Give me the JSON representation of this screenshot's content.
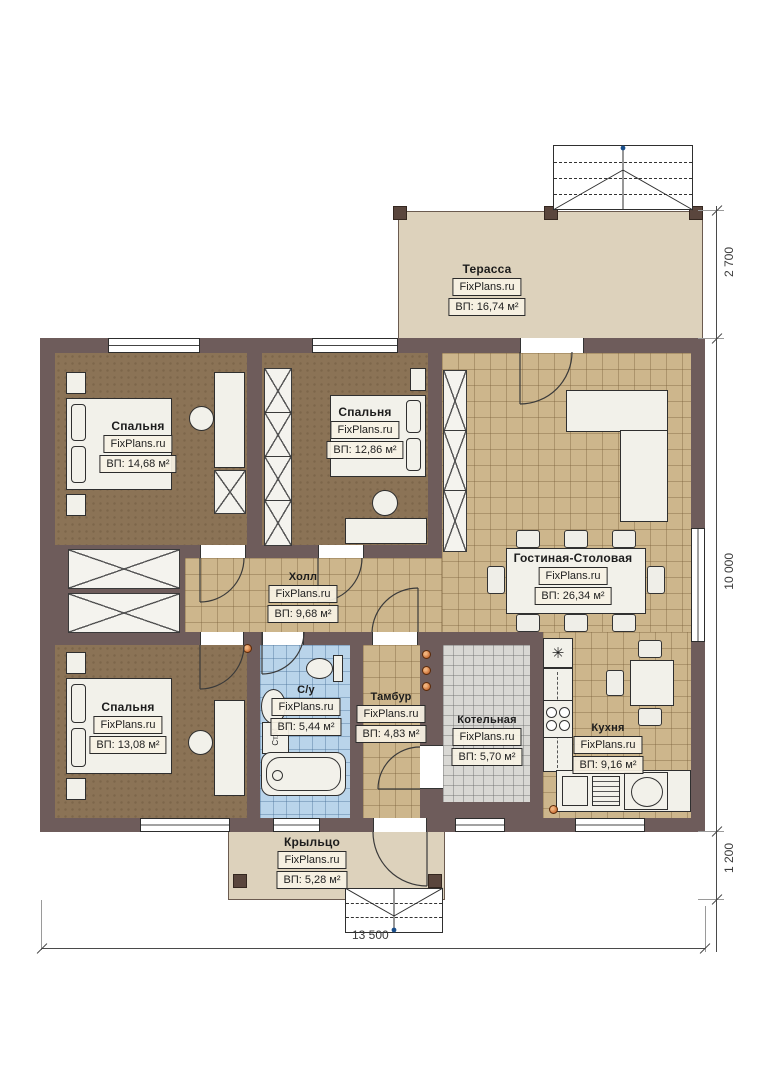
{
  "plan": {
    "brand": "FixPlans.ru",
    "rooms": {
      "terrace": {
        "name": "Терасса",
        "area": "ВП: 16,74 м²"
      },
      "bedroom1": {
        "name": "Спальня",
        "area": "ВП: 14,68 м²"
      },
      "bedroom2": {
        "name": "Спальня",
        "area": "ВП: 12,86 м²"
      },
      "hall": {
        "name": "Холл",
        "area": "ВП: 9,68 м²"
      },
      "living": {
        "name": "Гостиная-Столовая",
        "area": "ВП: 26,34 м²"
      },
      "bedroom3": {
        "name": "Спальня",
        "area": "ВП: 13,08 м²"
      },
      "bathroom": {
        "name": "С/у",
        "area": "ВП: 5,44 м²"
      },
      "tambur": {
        "name": "Тамбур",
        "area": "ВП: 4,83 м²"
      },
      "boiler": {
        "name": "Котельная",
        "area": "ВП: 5,70 м²"
      },
      "kitchen": {
        "name": "Кухня",
        "area": "ВП: 9,16 м²"
      },
      "porch": {
        "name": "Крыльцо",
        "area": "ВП: 5,28 м²"
      }
    },
    "fixtures": {
      "washing_machine": "Ст.М.",
      "hood_symbol": "✳"
    },
    "dimensions": {
      "terrace_depth": "2 700",
      "house_depth": "10 000",
      "porch_depth": "1 200",
      "house_width": "13 500"
    }
  }
}
